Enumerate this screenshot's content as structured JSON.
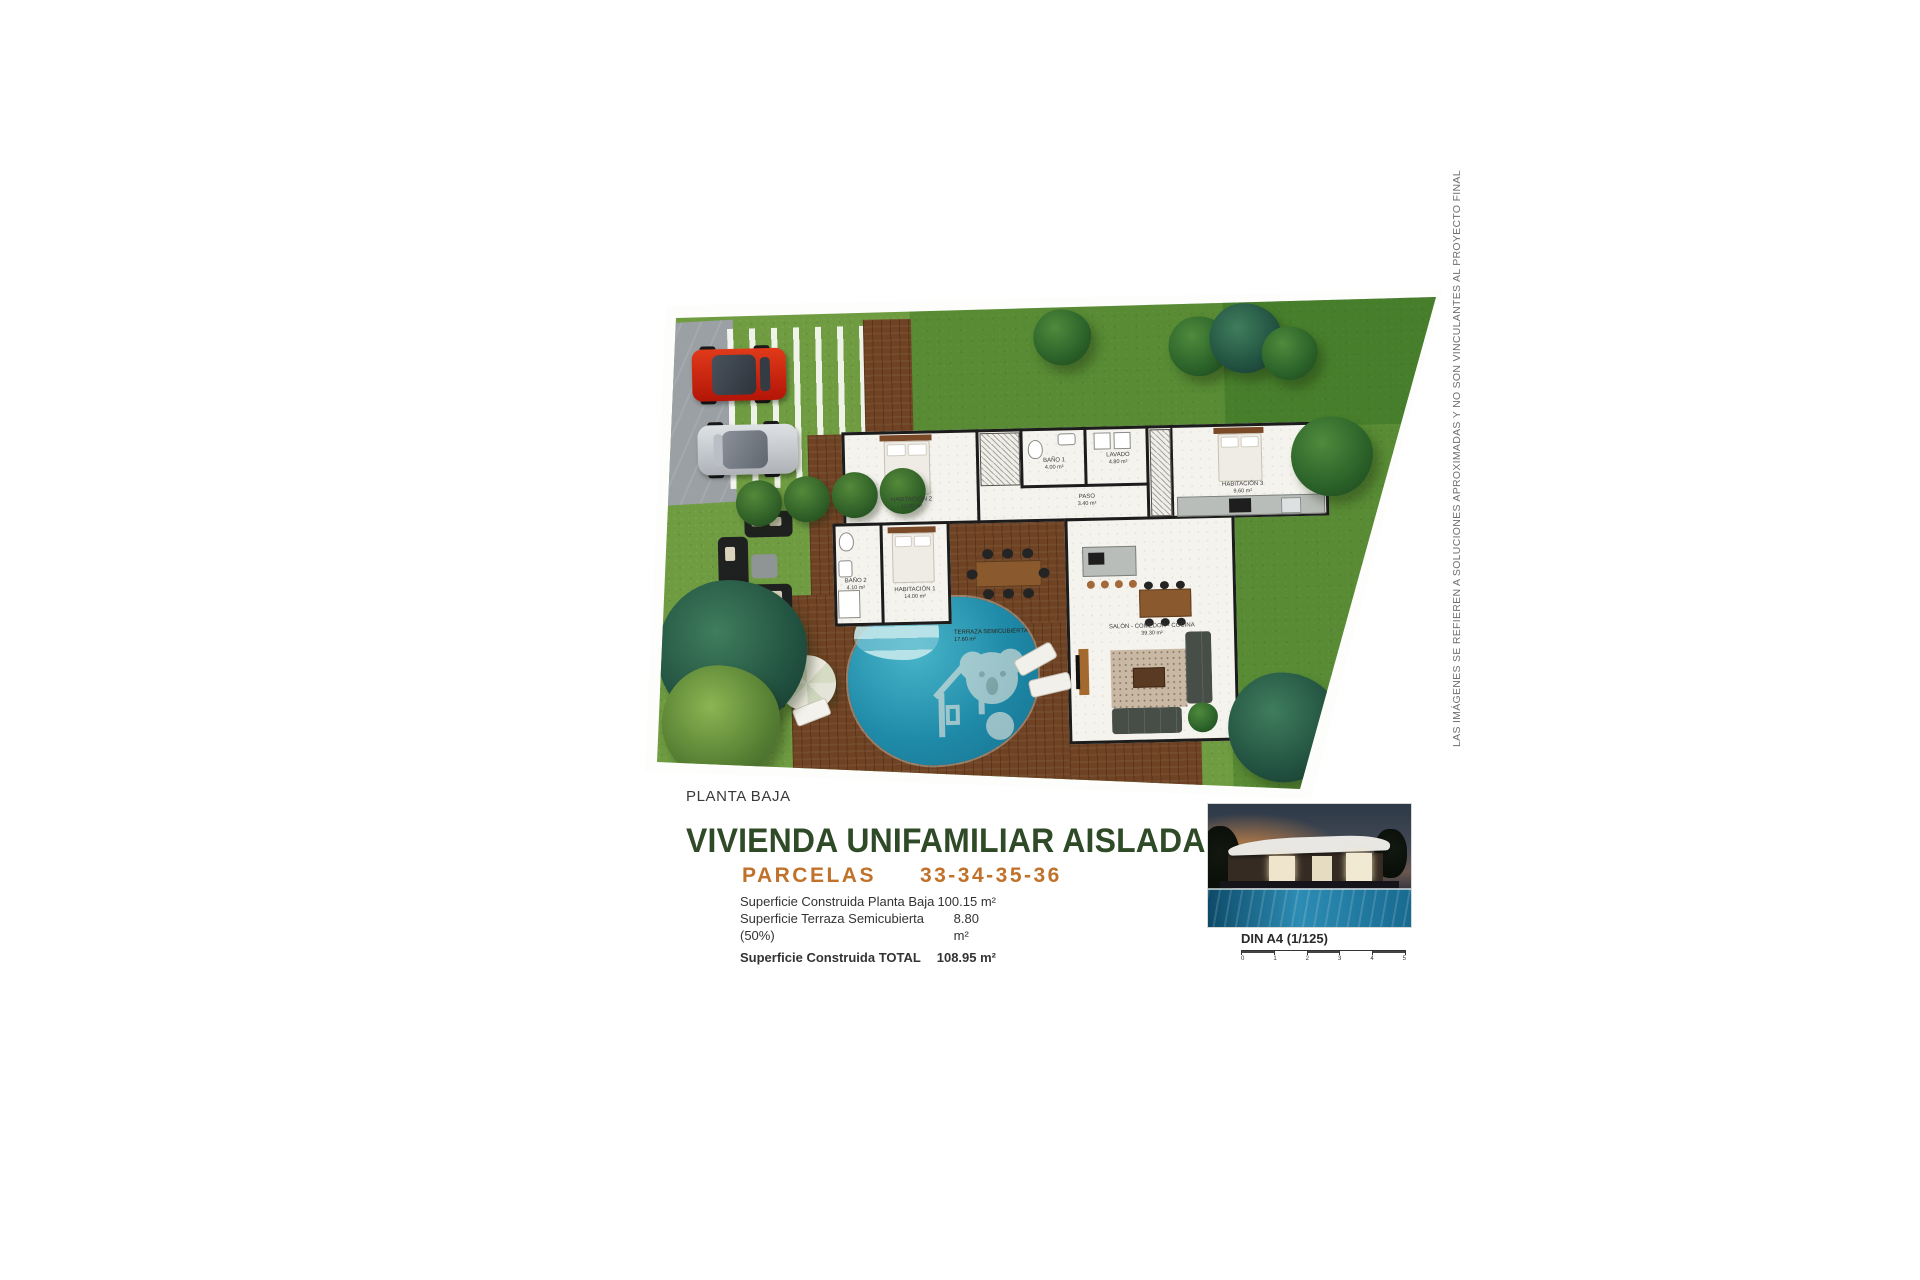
{
  "plan": {
    "caption": "PLANTA BAJA",
    "rooms": {
      "habitacion2": {
        "name": "HABITACIÓN 2",
        "area": "11.00 m²"
      },
      "bano1": {
        "name": "BAÑO 1",
        "area": "4.00 m²"
      },
      "lavado": {
        "name": "LAVADO",
        "area": "4.80 m²"
      },
      "paso": {
        "name": "PASO",
        "area": "3.40 m²"
      },
      "habitacion3": {
        "name": "HABITACIÓN 3",
        "area": "9.60 m²"
      },
      "bano2": {
        "name": "BAÑO 2",
        "area": "4.10 m²"
      },
      "habitacion1": {
        "name": "HABITACIÓN 1",
        "area": "14.00 m²"
      },
      "terraza": {
        "name": "TERRAZA SEMICUBIERTA",
        "area": "17.60 m²"
      },
      "salon": {
        "name": "SALÓN - COMEDOR - COCINA",
        "area": "39.30 m²"
      }
    }
  },
  "title_block": {
    "title": "VIVIENDA UNIFAMILIAR AISLADA",
    "parcels_label": "PARCELAS",
    "parcels_numbers": "33-34-35-36",
    "area_rows": [
      {
        "label": "Superficie Construida Planta Baja",
        "value": "100.15 m²"
      },
      {
        "label": "Superficie Terraza Semicubierta (50%)",
        "value": "8.80 m²"
      },
      {
        "label": "Superficie Construida TOTAL",
        "value": "108.95 m²"
      }
    ],
    "scale_label": "DIN A4 (1/125)",
    "scale_ticks": [
      "0",
      "1",
      "2",
      "3",
      "4",
      "5"
    ]
  },
  "disclaimer": "LAS IMÁGENES SE REFIEREN A SOLUCIONES APROXIMADAS Y NO SON VINCULANTES AL PROYECTO FINAL",
  "colors": {
    "title_green": "#2e4a26",
    "parcels_orange": "#c0712a",
    "grass": "#6f9c41",
    "deck_wood": "#6e4223",
    "pool_water": "#1f8aa8",
    "road_gray": "#9aa0a3",
    "wall_black": "#1c1c1c",
    "car_red": "#d23415",
    "car_silver": "#cfd3d6"
  }
}
